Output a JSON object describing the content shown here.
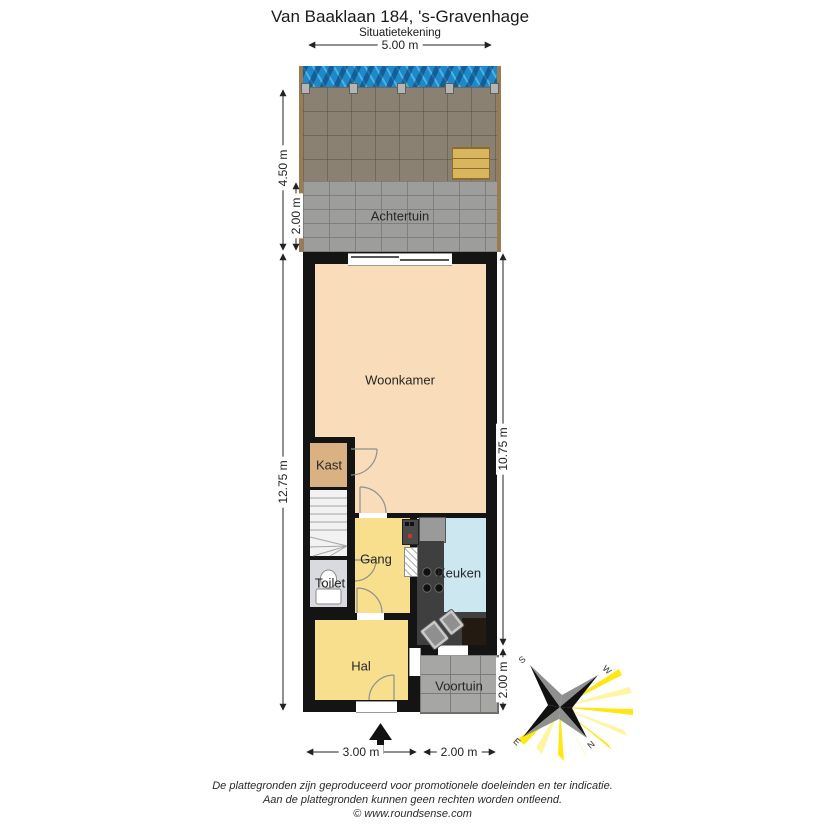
{
  "header": {
    "title": "Van Baaklaan 184, 's-Gravenhage",
    "subtitle": "Situatietekening"
  },
  "rooms": {
    "achtertuin": "Achtertuin",
    "woonkamer": "Woonkamer",
    "kast": "Kast",
    "gang": "Gang",
    "toilet": "Toilet",
    "keuken": "Keuken",
    "hal": "Hal",
    "voortuin": "Voortuin"
  },
  "dims": {
    "top_width": "5.00 m",
    "garden_depth": "4.50 m",
    "garden_lower": "2.00 m",
    "house_left": "12.75 m",
    "house_right": "10.75 m",
    "voortuin_right": "2.00 m",
    "house_bottom": "3.00 m",
    "voortuin_bottom": "2.00 m"
  },
  "compass": {
    "n": "N",
    "e": "E",
    "s": "S",
    "w": "W"
  },
  "footer": {
    "line1": "De plattegronden zijn geproduceerd voor promotionele doeleinden en ter indicatie.",
    "line2": "Aan de plattegronden kunnen geen rechten worden ontleend.",
    "line3": "© www.roundsense.com"
  },
  "colors": {
    "wall": "#141414",
    "woonkamer": "#f9dcba",
    "gang": "#f7df8e",
    "kast": "#d9b183",
    "keuken": "#cde7f0",
    "water": "#1e88c9",
    "garden-tiles": "#8a8173",
    "garden-bricks": "#9d9d9b",
    "voortuin": "#a6a6a4",
    "wood": "#d9b65e",
    "sun-ray": "#ffe60a"
  }
}
